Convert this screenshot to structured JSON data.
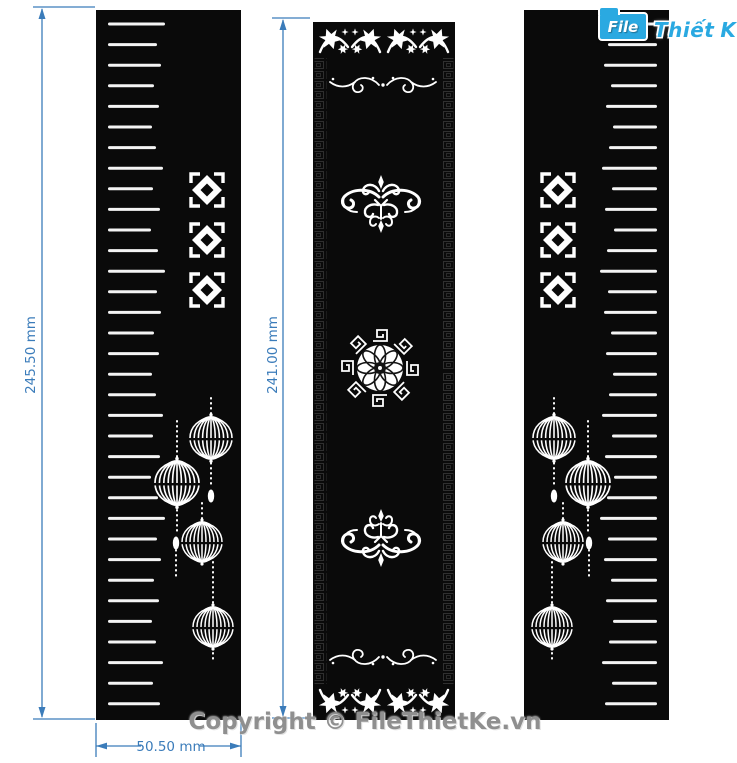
{
  "window": {
    "width": 737,
    "height": 763,
    "background": "#ffffff"
  },
  "logo": {
    "folder_text": "File",
    "brand_part1": "Thiết",
    "brand_part2": "Kế",
    "domain": ".vn",
    "accent_color": "#2aa9e1"
  },
  "watermark": {
    "text": "Copyright © FileThietKe.vn",
    "color": "#8f8f8f"
  },
  "dims": {
    "left_height_label": "245.50 mm",
    "middle_height_label": "241.00 mm",
    "bottom_width_label": "50.50 mm",
    "color": "#3b7cba"
  },
  "art": {
    "panel_color": "#0a0a0a",
    "cut_color": "#f4f4f4",
    "side_panel": {
      "x": 96,
      "y": 10,
      "width": 145,
      "height": 710
    },
    "middle_panel": {
      "x": 313,
      "y": 22,
      "width": 142,
      "height": 698
    },
    "slats": {
      "count": 34,
      "x": 108,
      "y_start": 24,
      "step": 20.6,
      "thickness": 3,
      "lengths": [
        57,
        49,
        53,
        46,
        51,
        44,
        48,
        55,
        45,
        52,
        43,
        50
      ]
    },
    "squares": {
      "cx": 207,
      "cys": [
        190,
        240,
        290
      ]
    },
    "lanterns": [
      {
        "cx": 211,
        "cy": 438,
        "rx": 21,
        "ry": 20
      },
      {
        "cx": 177,
        "cy": 483,
        "rx": 22,
        "ry": 21
      },
      {
        "cx": 202,
        "cy": 542,
        "rx": 20,
        "ry": 19
      },
      {
        "cx": 213,
        "cy": 627,
        "rx": 20,
        "ry": 19
      }
    ],
    "strings": [
      [
        211,
        398,
        418
      ],
      [
        211,
        458,
        488
      ],
      [
        202,
        503,
        522
      ],
      [
        177,
        421,
        461
      ],
      [
        177,
        505,
        535
      ],
      [
        176,
        550,
        576
      ],
      [
        213,
        562,
        606
      ],
      [
        213,
        648,
        660
      ]
    ],
    "pendants": [
      [
        211,
        496
      ],
      [
        176,
        543
      ]
    ]
  }
}
